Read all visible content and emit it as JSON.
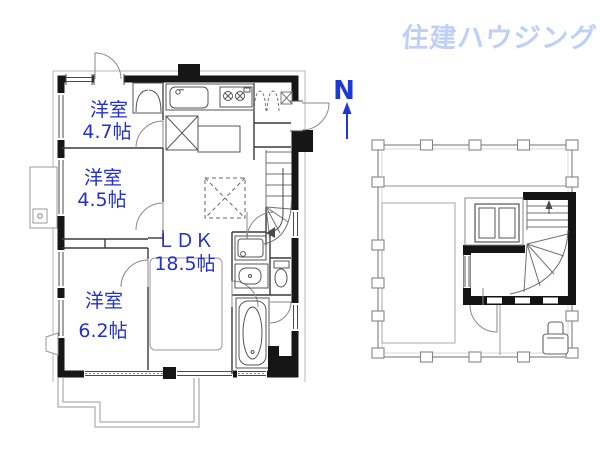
{
  "brand": {
    "logo_text": "住建ハウジング",
    "color": "#bdd1f6"
  },
  "compass": {
    "label": "N",
    "color": "#1c38d6"
  },
  "plan": {
    "label_color": "#2330c9",
    "rooms": [
      {
        "name": "洋室",
        "size": "4.7帖"
      },
      {
        "name": "洋室",
        "size": "4.5帖"
      },
      {
        "name": "ＬＤＫ",
        "size": "18.5帖"
      },
      {
        "name": "洋室",
        "size": "6.2帖"
      }
    ]
  }
}
